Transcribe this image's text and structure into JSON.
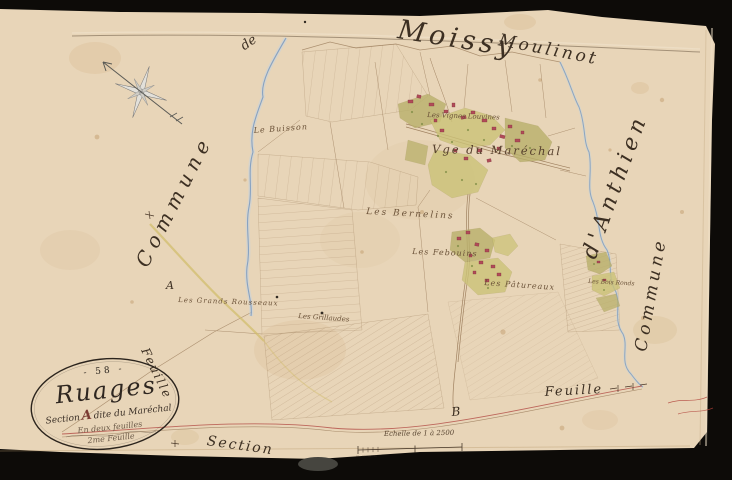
{
  "palette": {
    "paper": "#e8d5b8",
    "scan_background": "#0d0b08",
    "ink_dark": "#3c2f22",
    "ink_field": "#6b5238",
    "parcel_line": "#8d6c4a",
    "building_red": "#b14b58",
    "garden_green": "#b9b06b",
    "garden_yellow": "#ccc378",
    "stream_blue": "#7e9cc0",
    "road_red": "#b5524a",
    "road_yellow": "#d2bd6e",
    "cartouche_letter_red": "#7b3a32"
  },
  "margins": {
    "top_title": "Moissy",
    "top_title_right": "Moulinot",
    "left_small": "de",
    "left_commune": "Commune",
    "right_anthien": "d'Anthien",
    "right_commune": "Commune",
    "feuille_left": "Feuille",
    "feuille_right": "Feuille",
    "section_bottom": "Section",
    "marker_a": "A",
    "marker_b": "B"
  },
  "cartouche": {
    "number": "- 58 -",
    "title": "Ruages",
    "section_word": "Section",
    "section_letter": "A",
    "section_rest": "dite du Maréchal",
    "feuilles_line": "En deux feuilles",
    "feuille_num": "2me Feuille"
  },
  "scale": {
    "label": "Echelle de 1 à 2500"
  },
  "field_labels": {
    "buisson": "Le Buisson",
    "vignes": "Les Vignes Louvines",
    "village": "Vge du Maréchal",
    "bernelins": "Les Bernelins",
    "febouins": "Les Febouins",
    "patureaux": "Les Pâtureaux",
    "rousseaux": "Les Grands Rousseaux",
    "grillaudes": "Les Grillaudes",
    "bois": "Les Bois Ronds"
  }
}
